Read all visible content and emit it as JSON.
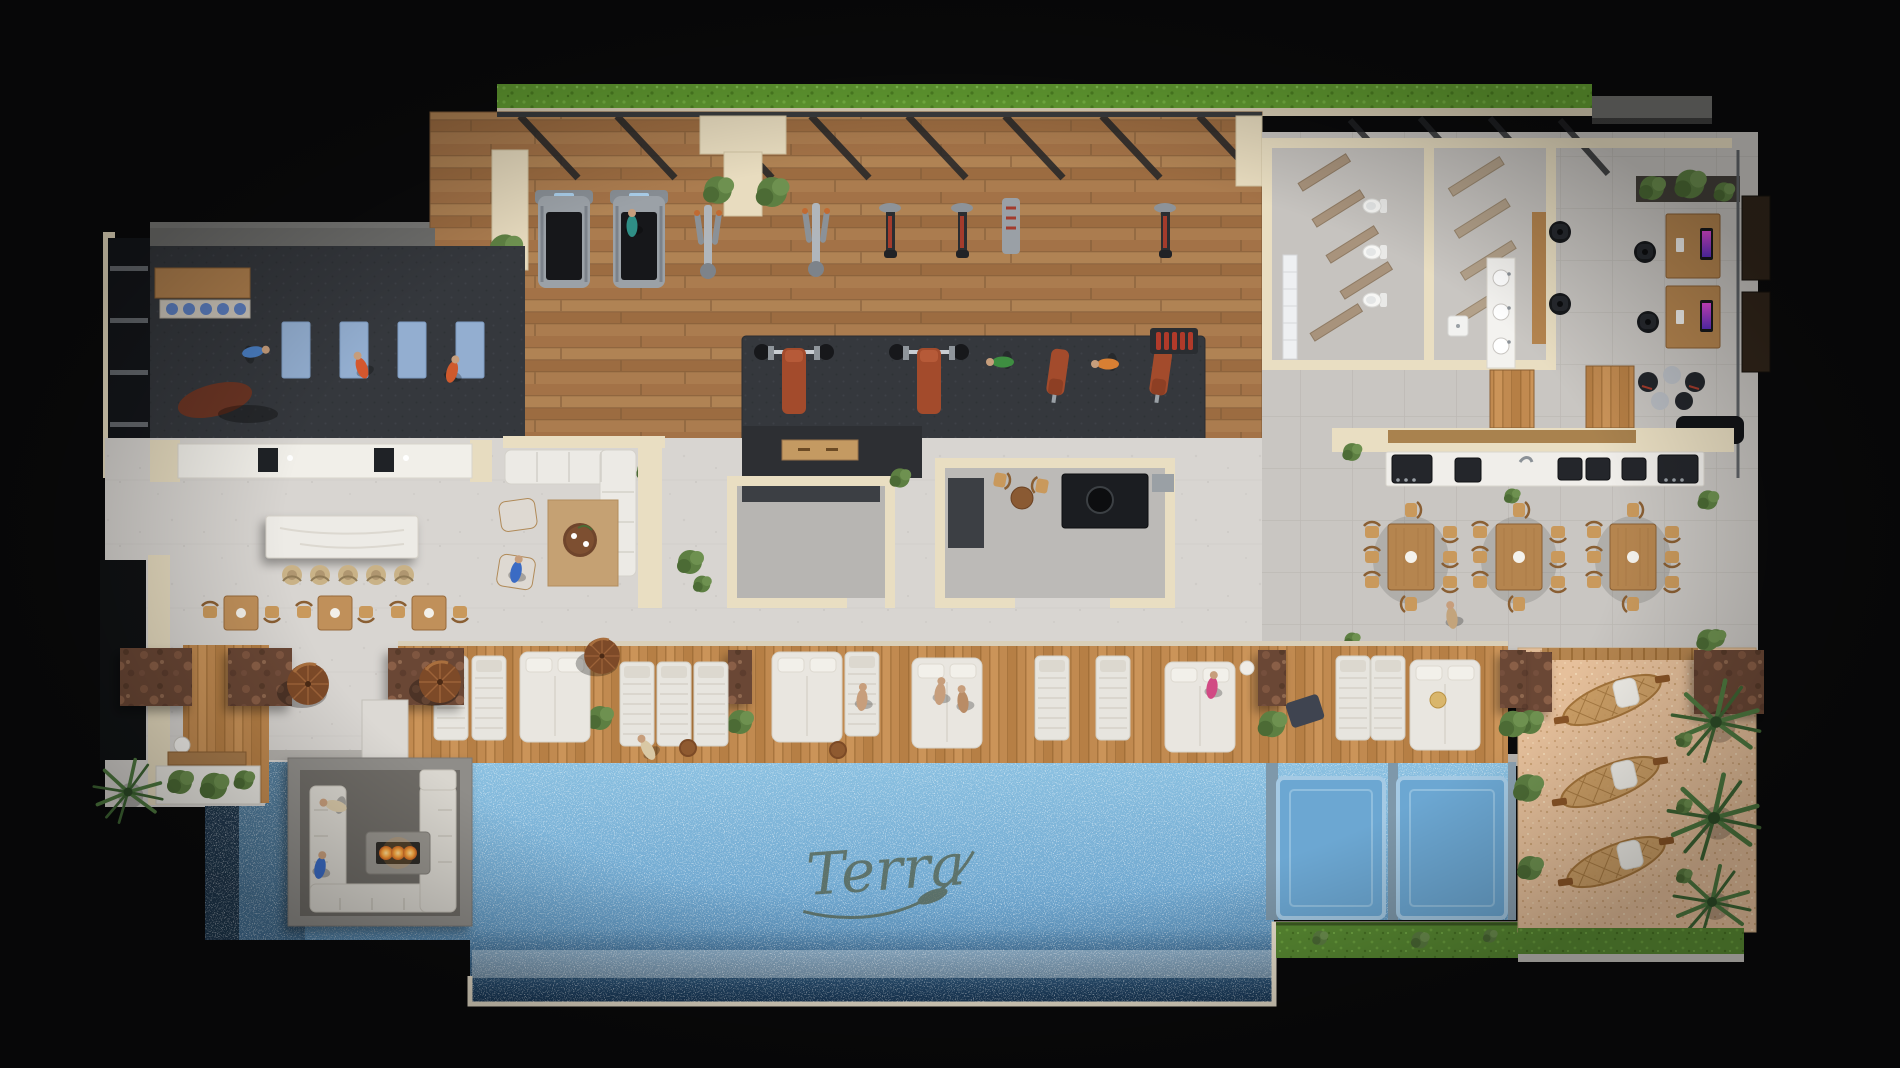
{
  "scene": {
    "title": "Rooftop amenity level — top-down 3D floor plan render",
    "style": "photorealistic architectural rendering viewed from directly above on a black backdrop",
    "watermark_signature": "Terra",
    "canvas": {
      "width": 1900,
      "height": 1068
    }
  },
  "palette": {
    "background": "#0a0a0b",
    "wall_cream": "#e9dec2",
    "concrete": "#d8d5d1",
    "tile": "#c9c6c2",
    "gym_wood": "#a87c4e",
    "deck_wood": "#c18a50",
    "rubber_mat": "#35383d",
    "pool_light": "#8cc1e1",
    "pool_deep": "#44759c",
    "sand": "#e6c09b",
    "grass": "#5a8c33",
    "hedge": "#64a032",
    "stone_rust": "#6b4734",
    "leather_bench": "#a34b2c",
    "fire_glow": "#f6a23c",
    "yoga_mat": "#93aed0",
    "monitor_glow": "#d23bd0",
    "umbrella_copper": "#7d4a28",
    "white_upholstery": "#e9e6e0"
  },
  "zones": [
    {
      "id": "cardio-gym",
      "label": "Cardio gym",
      "floor": "hardwood plank",
      "items": [
        "2 treadmills",
        "2 ellipticals",
        "3 spin bikes",
        "stair climber",
        "pergola beams",
        "roof hedge planter"
      ],
      "people": 1
    },
    {
      "id": "yoga-studio",
      "label": "Yoga / stretching studio",
      "floor": "dark rubber",
      "items": [
        "4 blue yoga mats",
        "punching bag",
        "balance-ball shelf",
        "wood bench",
        "window wall"
      ],
      "people": 3
    },
    {
      "id": "strength-zone",
      "label": "Free-weights zone",
      "floor": "rubber mat",
      "items": [
        "2 barbell bench stations",
        "2 incline benches",
        "2 dumbbell racks",
        "plate rack",
        "flat bench"
      ],
      "people": 2
    },
    {
      "id": "wellness-counter",
      "label": "Hydration counter",
      "items": [
        "white counter",
        "2 coffee/water stations"
      ]
    },
    {
      "id": "locker-restrooms",
      "label": "Restrooms, showers & lockers",
      "items": [
        "3 toilets",
        "vanity with 3 basins",
        "towel shelves",
        "cubby shelves",
        "bench"
      ]
    },
    {
      "id": "coworking",
      "label": "Co-working lounge",
      "items": [
        "2 wood desks",
        "2 monitors",
        "4 task chairs",
        "glass partition",
        "2 dark doors",
        "stool cluster",
        "black sofa"
      ]
    },
    {
      "id": "service-core",
      "label": "Service core / media rooms",
      "items": [
        "media wall",
        "wood console",
        "gray floor rooms"
      ]
    },
    {
      "id": "catering-kitchen",
      "label": "Catering kitchen & bar",
      "items": [
        "black island counter",
        "round basin",
        "appliance",
        "2 wood chairs",
        "round table"
      ]
    },
    {
      "id": "espresso-bar",
      "label": "Pool bar",
      "items": [
        "marble island",
        "5 rattan stools",
        "3 café tables with 2 chairs each"
      ]
    },
    {
      "id": "residents-lounge",
      "label": "Residents' lounge",
      "items": [
        "L-sectional sofa",
        "2 armchairs",
        "round coffee table",
        "tan rug"
      ],
      "people": 2
    },
    {
      "id": "grill-station",
      "label": "BBQ grill station",
      "items": [
        "6 grills",
        "white prep counter",
        "wood pergola strip"
      ]
    },
    {
      "id": "dining-terrace",
      "label": "Outdoor dining terrace",
      "items": [
        "3 wood tables",
        "8 bentwood chairs per table",
        "planters"
      ],
      "people": 1
    },
    {
      "id": "cabana-lounge",
      "label": "Cabana lounge",
      "items": [
        "3 stone privacy walls",
        "3 copper umbrellas",
        "wood deck inset",
        "sphere lamp",
        "bench",
        "white planter"
      ]
    },
    {
      "id": "sun-deck",
      "label": "Pool sun deck",
      "items": [
        "5 daybeds",
        "10 sun loungers",
        "3 stone dividers with planters",
        "side tables",
        "towels",
        "straw hat"
      ],
      "people": 5
    },
    {
      "id": "fire-lounge",
      "label": "Sunken fire-pit island",
      "items": [
        "U-shaped sofa",
        "linear fire table with 3 flames",
        "paver apron",
        "bridge walkway"
      ],
      "people": 2
    },
    {
      "id": "pool",
      "label": "Infinity-edge pool",
      "items": [
        "2 tanning ledges",
        "cream infinity rim",
        "foam edge",
        "signature watermark"
      ]
    },
    {
      "id": "beach-lounge",
      "label": "Sand beach lounge",
      "items": [
        "3 net hammocks with white pillows",
        "3 palm trees",
        "potted plants",
        "stone walls",
        "grass border"
      ]
    }
  ],
  "inventory_totals": {
    "people": 15,
    "palm_trees": 4,
    "planters": 16,
    "sun_loungers": 10,
    "daybeds": 5,
    "hammocks": 3,
    "umbrellas": 3,
    "dining_chairs": 24,
    "bar_stools": 5,
    "grills": 6,
    "cardio_machines": 7,
    "yoga_mats": 4,
    "toilets": 3,
    "sink_basins": 6,
    "desks": 2,
    "office_chairs": 4,
    "monitors": 2,
    "tanning_ledges": 2,
    "fire_pits": 1
  }
}
